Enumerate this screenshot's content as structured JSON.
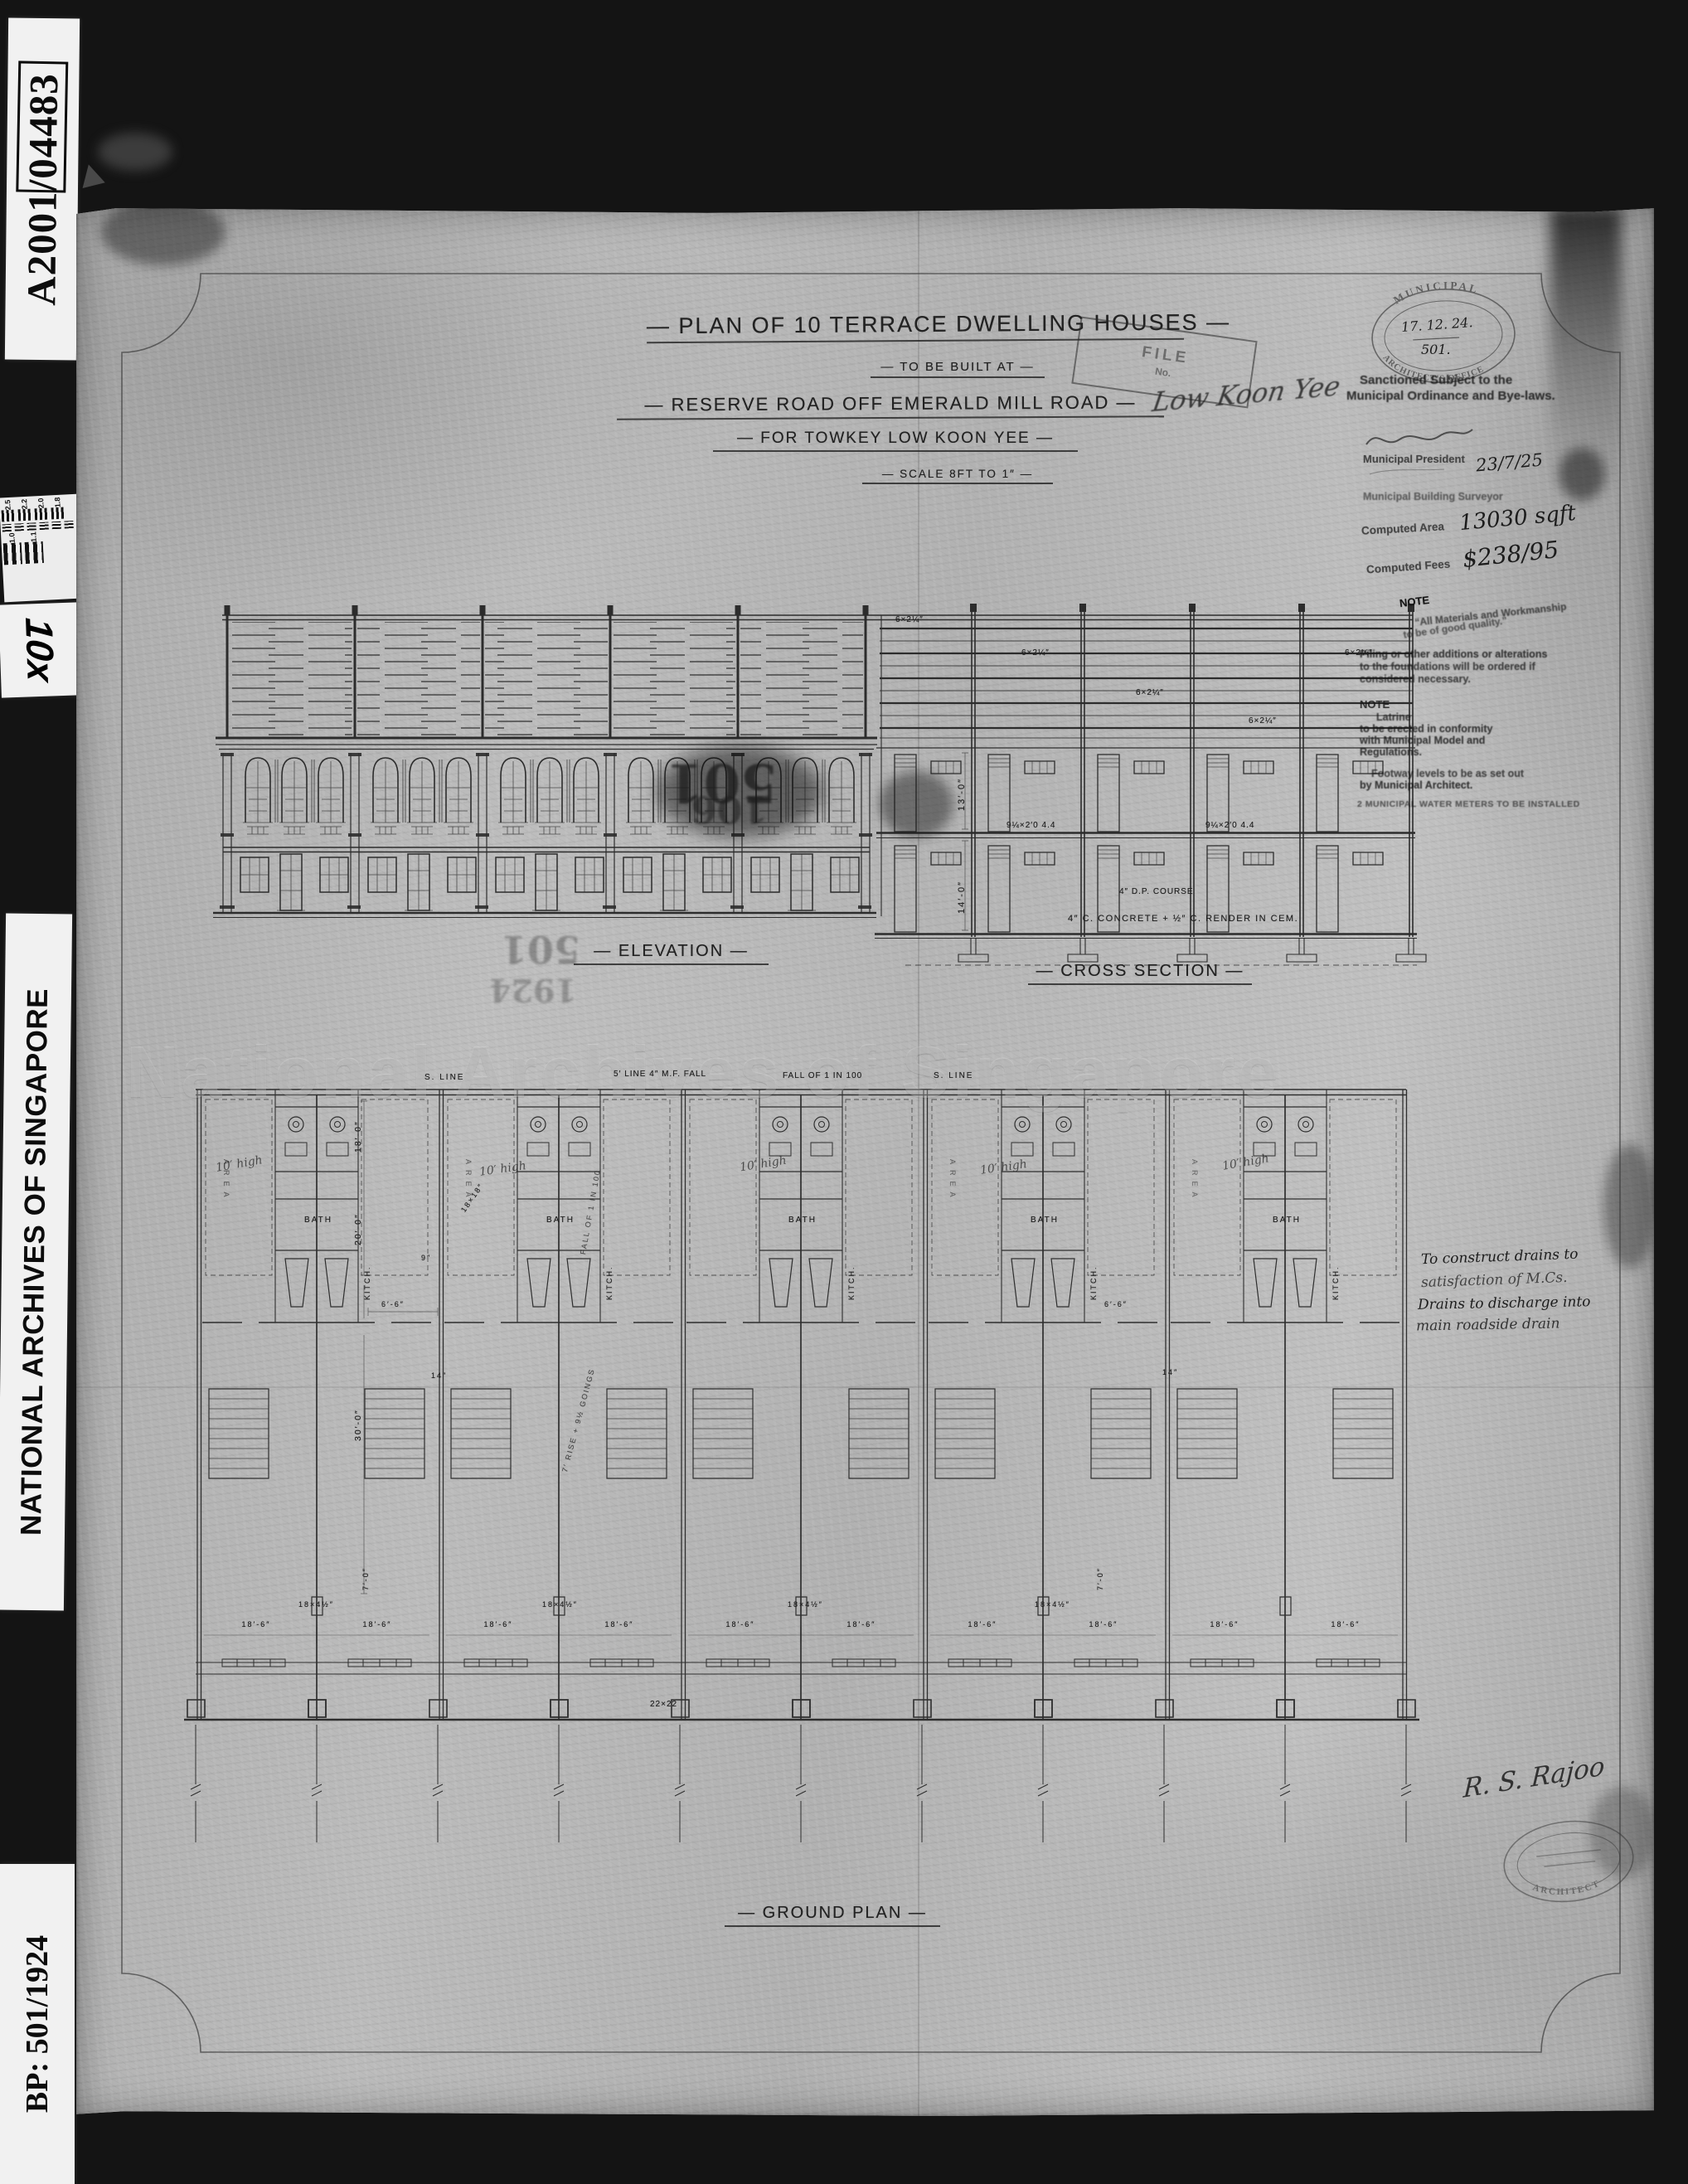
{
  "sidebar": {
    "accession_no": "A2001/04483",
    "magnification": "10x",
    "archive_name": "NATIONAL ARCHIVES OF SINGAPORE",
    "plan_ref": "BP: 501/1924",
    "targets_top": [
      "2.5",
      "2.2",
      "2.0",
      "1.8"
    ],
    "targets_bottom": [
      "1.0",
      "1.1"
    ]
  },
  "watermark": "National Archives of Singapore",
  "title_block": {
    "title": "— PLAN OF 10 TERRACE DWELLING HOUSES —",
    "built_at": "— TO BE BUILT AT —",
    "location": "— RESERVE ROAD OFF EMERALD MILL ROAD —",
    "client": "— FOR TOWKEY LOW KOON YEE —",
    "scale": "— SCALE 8FT TO 1″ —",
    "file_stamp_l1": "FILE",
    "file_stamp_l2": "No.",
    "owner_signature": "Low Koon Yee"
  },
  "sanction": {
    "office_top": "MUNICIPAL",
    "office_bottom": "ARCHITECT'S OFFICE",
    "stamp_date": "17. 12. 24.",
    "stamp_no": "501.",
    "line1": "Sanctioned Subject to the",
    "line2": "Municipal Ordinance and Bye-laws.",
    "president_title": "Municipal President",
    "approval_date": "23/7/25",
    "surveyor_title": "Municipal Building Surveyor",
    "area_label": "Computed Area",
    "area_value": "13030 sqft",
    "fees_label": "Computed Fees",
    "fees_value": "$238/95",
    "note1_head": "NOTE",
    "note1_l1": "“All Materials and Workmanship",
    "note1_l2": "to be of good quality.”",
    "note2_l1": "Piling or other additions or alterations",
    "note2_l2": "to the foundations will be ordered if",
    "note2_l3": "considered necessary.",
    "note3_head": "NOTE",
    "note3_l1": "Latrine",
    "note3_l2": "to be erected in conformity",
    "note3_l3": "with Municipal Model and",
    "note3_l4": "Regulations.",
    "note4_l1": "Footway levels to be as set out",
    "note4_l2": "by Municipal Architect.",
    "meters": "2 MUNICIPAL WATER METERS TO BE INSTALLED"
  },
  "drawing_labels": {
    "elevation": "— ELEVATION —",
    "cross_section": "— CROSS SECTION —",
    "ground_plan": "— GROUND PLAN —"
  },
  "section": {
    "rafter": "6×2¼″",
    "beam": "9¼×2′0 4.4",
    "dpc": "4″ D.P. COURSE",
    "slab": "4″ C. CONCRETE + ½″ C. RENDER IN CEM.",
    "dim_upper": "13′-0″",
    "dim_lower": "14′-0″"
  },
  "plan": {
    "s_line": "S. LINE",
    "mf_line": "5′ LINE 4″ M.F. FALL",
    "fall": "FALL OF 1 IN 100",
    "bath": "BATH",
    "kitchen": "KITCH.",
    "area": "AREA",
    "high_note": "10′ high",
    "dim_18_0": "18′-0″",
    "dim_20_0": "20′-0″",
    "dim_30_0": "30′-0″",
    "dim_6_6": "6′-6″",
    "dim_14": "14″",
    "dim_9": "9″",
    "dim_18x18": "18×18″",
    "dim_18x45": "18×4½″",
    "dim_18_6": "18′-6″",
    "dim_22x22": "22×22",
    "dim_7_0": "7′-0″",
    "stair_note": "7′ RISE + 9½ GOINGS",
    "drain_l1": "To construct drains to",
    "drain_l2": "satisfaction of M.Cs.",
    "drain_l3": "Drains to discharge into",
    "drain_l4": "main roadside drain",
    "ghost_a": "501",
    "ghost_b": "1924",
    "ghost_c": "106"
  },
  "signature_block": {
    "architect_signature": "R. S. Rajoo",
    "architect_stamp": "ARCHITECT"
  }
}
